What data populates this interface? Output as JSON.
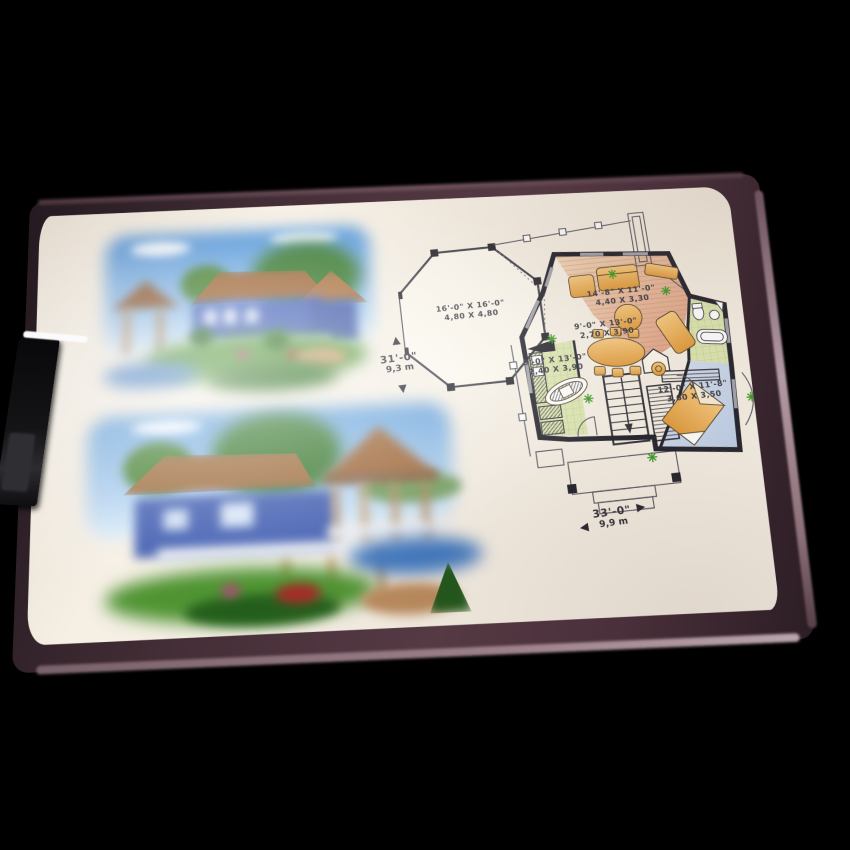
{
  "photo": {
    "subject": "Clipboard photographed on black background holding a house-plan sheet",
    "background_color": "#000000",
    "board_color": "#4a303a",
    "board_rim_highlight": "#b49aa4",
    "paper_color": "#f5efe4",
    "clip_color": "#141416"
  },
  "renderings": {
    "top": {
      "label": "house-exterior-rendering-1",
      "sky": "#5c9fe0",
      "roof": "#9c6434",
      "walls": "#4663b8",
      "grass": "#55983a",
      "water": "#4f86c8"
    },
    "bottom": {
      "label": "house-exterior-rendering-2-gazebo",
      "sky": "#7fb2e4",
      "roof": "#9c6838",
      "walls": "#3f5cb0",
      "grass": "#4f9432",
      "water": "#3f78c0"
    }
  },
  "floor_plan": {
    "wall_color": "#23232d",
    "floors": {
      "living": "#e9c3a0",
      "kitchen_bath": "#dce6b2",
      "bedroom": "#ccd9ea",
      "furniture": "#edb45e",
      "plants": "#3f9a28"
    },
    "rooms": [
      {
        "id": "veranda",
        "imperial": "16'-0\" X 16'-0\"",
        "metric": "4,80 X 4,80"
      },
      {
        "id": "living",
        "imperial": "14'-8\" X 11'-0\"",
        "metric": "4,40 X 3,30"
      },
      {
        "id": "dining",
        "imperial": "9'-0\" X 13'-0\"",
        "metric": "2,70 X 3,90"
      },
      {
        "id": "kitchen",
        "imperial": "8'-0\" X 13'-0\"",
        "metric": "2,40 X 3,90"
      },
      {
        "id": "bedroom",
        "imperial": "12'-0\" X 11'-8\"",
        "metric": "3,60 X 3,50"
      }
    ],
    "dimensions": {
      "depth": {
        "imperial": "31'-0\"",
        "metric": "9,3 m"
      },
      "width": {
        "imperial": "33'-0\"",
        "metric": "9,9 m"
      }
    },
    "icons": {
      "up_arrow": "▲",
      "down_arrow": "▼",
      "left_arrow": "◀",
      "right_arrow": "▶"
    }
  }
}
